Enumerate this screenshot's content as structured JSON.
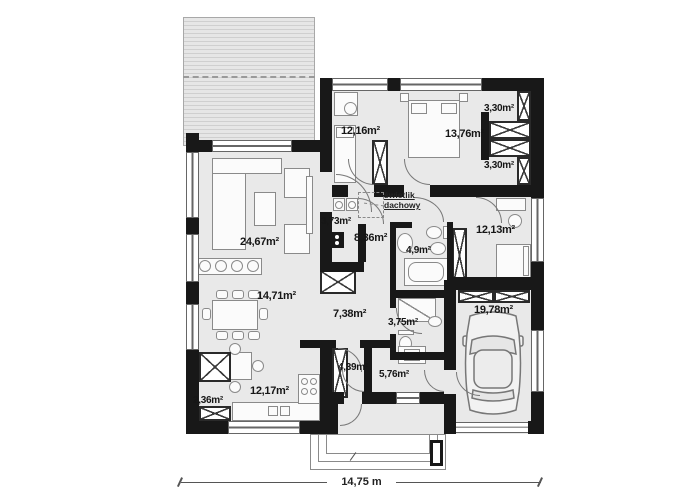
{
  "plan": {
    "rooms": {
      "living_room": {
        "area": "24,67m²"
      },
      "dining_area": {
        "area": "14,71m²"
      },
      "kitchen": {
        "area": "12,17m²"
      },
      "closet": {
        "area": "2,36m²"
      },
      "bedroom_top_left": {
        "area": "12,16m²"
      },
      "bedroom_top_mid": {
        "area": "13,76m²"
      },
      "wardrobe_upper": {
        "area": "3,30m²"
      },
      "wardrobe_lower": {
        "area": "3,30m²"
      },
      "laundry": {
        "area": "3,73m²"
      },
      "hallway": {
        "area": "8,36m²"
      },
      "bathroom": {
        "area": "4,9m²"
      },
      "bedroom_right": {
        "area": "12,13m²"
      },
      "corridor": {
        "area": "7,38m²"
      },
      "wc": {
        "area": "3,75m²"
      },
      "pantry": {
        "area": "4,39m²"
      },
      "utility_room": {
        "area": "5,76m²"
      },
      "garage": {
        "area": "19,78m²"
      }
    },
    "annotations": {
      "skylight_line1": "świetlik",
      "skylight_line2": "dachowy",
      "overall_width": "14,75 m"
    },
    "colors": {
      "wall": "#181818",
      "room_fill": "#e9e9e9",
      "terrace_stripe": "#cfcfcf",
      "outline_gray": "#8a8a8a"
    }
  }
}
